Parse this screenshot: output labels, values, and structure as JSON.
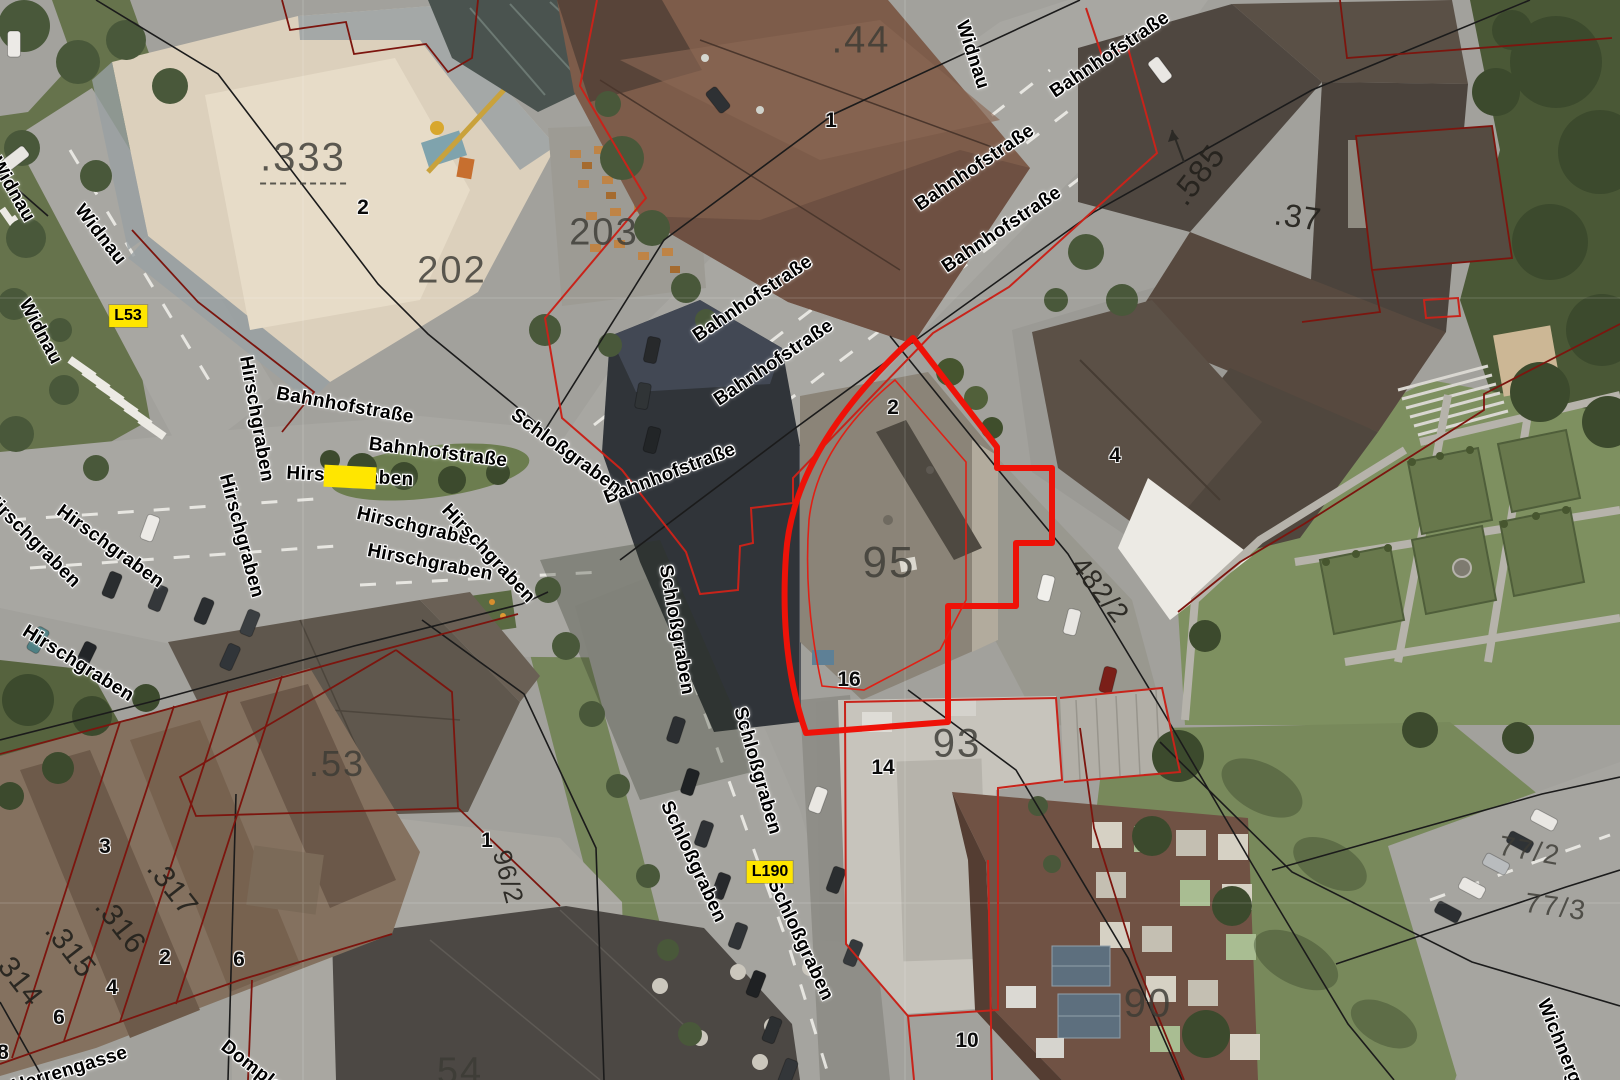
{
  "colors": {
    "selected_parcel_outline": "#ee1208",
    "cadastral_red": "#7c150e",
    "cadastral_bright_red": "#c8231a",
    "cadastral_black": "#1b1b1b",
    "badge_background": "#ffe600",
    "badge_text": "#000000",
    "street_label_halo": "#ffffff"
  },
  "map": {
    "selected_parcel": {
      "label": "95"
    },
    "street_labels": [
      {
        "text": "Widnau",
        "x": 972,
        "y": 55,
        "rot": 72
      },
      {
        "text": "Widnau",
        "x": 12,
        "y": 190,
        "rot": 60
      },
      {
        "text": "Widnau",
        "x": 100,
        "y": 235,
        "rot": 52
      },
      {
        "text": "Widnau",
        "x": 40,
        "y": 332,
        "rot": 62
      },
      {
        "text": "Bahnhofstraße",
        "x": 753,
        "y": 299,
        "rot": -34
      },
      {
        "text": "Bahnhofstraße",
        "x": 774,
        "y": 363,
        "rot": -34
      },
      {
        "text": "Bahnhofstraße",
        "x": 975,
        "y": 168,
        "rot": -34
      },
      {
        "text": "Bahnhofstraße",
        "x": 1002,
        "y": 230,
        "rot": -34
      },
      {
        "text": "Bahnhofstraße",
        "x": 1110,
        "y": 55,
        "rot": -34
      },
      {
        "text": "Bahnhofstraße",
        "x": 345,
        "y": 406,
        "rot": 10
      },
      {
        "text": "Bahnhofstraße",
        "x": 438,
        "y": 453,
        "rot": 7
      },
      {
        "text": "Bahnhofstraße",
        "x": 670,
        "y": 474,
        "rot": -21
      },
      {
        "text": "Hirschgraben",
        "x": 256,
        "y": 419,
        "rot": 80
      },
      {
        "text": "Hirschgraben",
        "x": 350,
        "y": 477,
        "rot": 3
      },
      {
        "text": "Hirschgraben",
        "x": 32,
        "y": 540,
        "rot": 45
      },
      {
        "text": "Hirschgraben",
        "x": 110,
        "y": 547,
        "rot": 36
      },
      {
        "text": "Hirschgraben",
        "x": 241,
        "y": 536,
        "rot": 75
      },
      {
        "text": "Hirschgraben",
        "x": 419,
        "y": 528,
        "rot": 13
      },
      {
        "text": "Hirschgraben",
        "x": 430,
        "y": 563,
        "rot": 11
      },
      {
        "text": "Hirschgraben",
        "x": 488,
        "y": 554,
        "rot": 47
      },
      {
        "text": "Hirschgraben",
        "x": 78,
        "y": 664,
        "rot": 32
      },
      {
        "text": "Schloßgraben",
        "x": 566,
        "y": 452,
        "rot": 36
      },
      {
        "text": "Schloßgraben",
        "x": 676,
        "y": 630,
        "rot": 80
      },
      {
        "text": "Schloßgraben",
        "x": 757,
        "y": 771,
        "rot": 74
      },
      {
        "text": "Schloßgraben",
        "x": 693,
        "y": 862,
        "rot": 65
      },
      {
        "text": "Schloßgraben",
        "x": 800,
        "y": 940,
        "rot": 65
      },
      {
        "text": "Herrengasse",
        "x": 70,
        "y": 1070,
        "rot": -17
      },
      {
        "text": "Domplatz",
        "x": 258,
        "y": 1072,
        "rot": 38
      },
      {
        "text": "Wichnergasse",
        "x": 1567,
        "y": 1062,
        "rot": 68
      }
    ],
    "street_highlight": {
      "street": "Hirschgraben",
      "x": 350,
      "y": 477,
      "w": 52,
      "h": 22,
      "rot": 3
    },
    "route_badges": [
      {
        "text": "L53",
        "x": 128,
        "y": 316
      },
      {
        "text": "L190",
        "x": 770,
        "y": 872
      }
    ],
    "parcel_labels": [
      {
        "text": ".333",
        "x": 303,
        "y": 160,
        "rot": 0,
        "size": 40,
        "variant": "",
        "underline": true
      },
      {
        "text": "202",
        "x": 452,
        "y": 271,
        "rot": 0,
        "size": 38,
        "variant": ""
      },
      {
        "text": "203",
        "x": 604,
        "y": 233,
        "rot": 0,
        "size": 38,
        "variant": ""
      },
      {
        "text": ".44",
        "x": 861,
        "y": 41,
        "rot": 0,
        "size": 38,
        "variant": ""
      },
      {
        "text": ".585",
        "x": 1198,
        "y": 175,
        "rot": -52,
        "size": 32,
        "variant": "dark"
      },
      {
        "text": ".37",
        "x": 1298,
        "y": 217,
        "rot": 8,
        "size": 32,
        "variant": "dark"
      },
      {
        "text": "95",
        "x": 889,
        "y": 563,
        "rot": 0,
        "size": 44,
        "variant": ""
      },
      {
        "text": "93",
        "x": 957,
        "y": 744,
        "rot": 0,
        "size": 40,
        "variant": ""
      },
      {
        "text": "90",
        "x": 1148,
        "y": 1004,
        "rot": 0,
        "size": 40,
        "variant": ""
      },
      {
        "text": ".53",
        "x": 337,
        "y": 764,
        "rot": 0,
        "size": 36,
        "variant": ""
      },
      {
        "text": ".317",
        "x": 172,
        "y": 888,
        "rot": 52,
        "size": 30,
        "variant": "dark"
      },
      {
        "text": ".316",
        "x": 120,
        "y": 926,
        "rot": 52,
        "size": 30,
        "variant": "dark"
      },
      {
        "text": ".315",
        "x": 70,
        "y": 950,
        "rot": 52,
        "size": 30,
        "variant": "dark"
      },
      {
        "text": "314",
        "x": 20,
        "y": 982,
        "rot": 52,
        "size": 30,
        "variant": "dark"
      },
      {
        "text": "96/2",
        "x": 508,
        "y": 877,
        "rot": 75,
        "size": 26,
        "variant": "dark"
      },
      {
        "text": "482/2",
        "x": 1100,
        "y": 590,
        "rot": 52,
        "size": 28,
        "variant": "dark"
      },
      {
        "text": "77/2",
        "x": 1530,
        "y": 851,
        "rot": 10,
        "size": 28,
        "variant": ""
      },
      {
        "text": "77/3",
        "x": 1556,
        "y": 907,
        "rot": 8,
        "size": 28,
        "variant": ""
      },
      {
        "text": "54",
        "x": 460,
        "y": 1072,
        "rot": 0,
        "size": 38,
        "variant": ""
      }
    ],
    "house_numbers": [
      {
        "text": "2",
        "x": 363,
        "y": 208
      },
      {
        "text": "1",
        "x": 831,
        "y": 121
      },
      {
        "text": "2",
        "x": 893,
        "y": 408
      },
      {
        "text": "16",
        "x": 849,
        "y": 680
      },
      {
        "text": "14",
        "x": 883,
        "y": 768
      },
      {
        "text": "10",
        "x": 967,
        "y": 1041
      },
      {
        "text": "4",
        "x": 1115,
        "y": 456
      },
      {
        "text": "3",
        "x": 105,
        "y": 847
      },
      {
        "text": "2",
        "x": 165,
        "y": 958
      },
      {
        "text": "6",
        "x": 239,
        "y": 960
      },
      {
        "text": "4",
        "x": 112,
        "y": 988
      },
      {
        "text": "6",
        "x": 59,
        "y": 1018
      },
      {
        "text": "8",
        "x": 3,
        "y": 1053
      },
      {
        "text": "1",
        "x": 487,
        "y": 841
      }
    ]
  }
}
